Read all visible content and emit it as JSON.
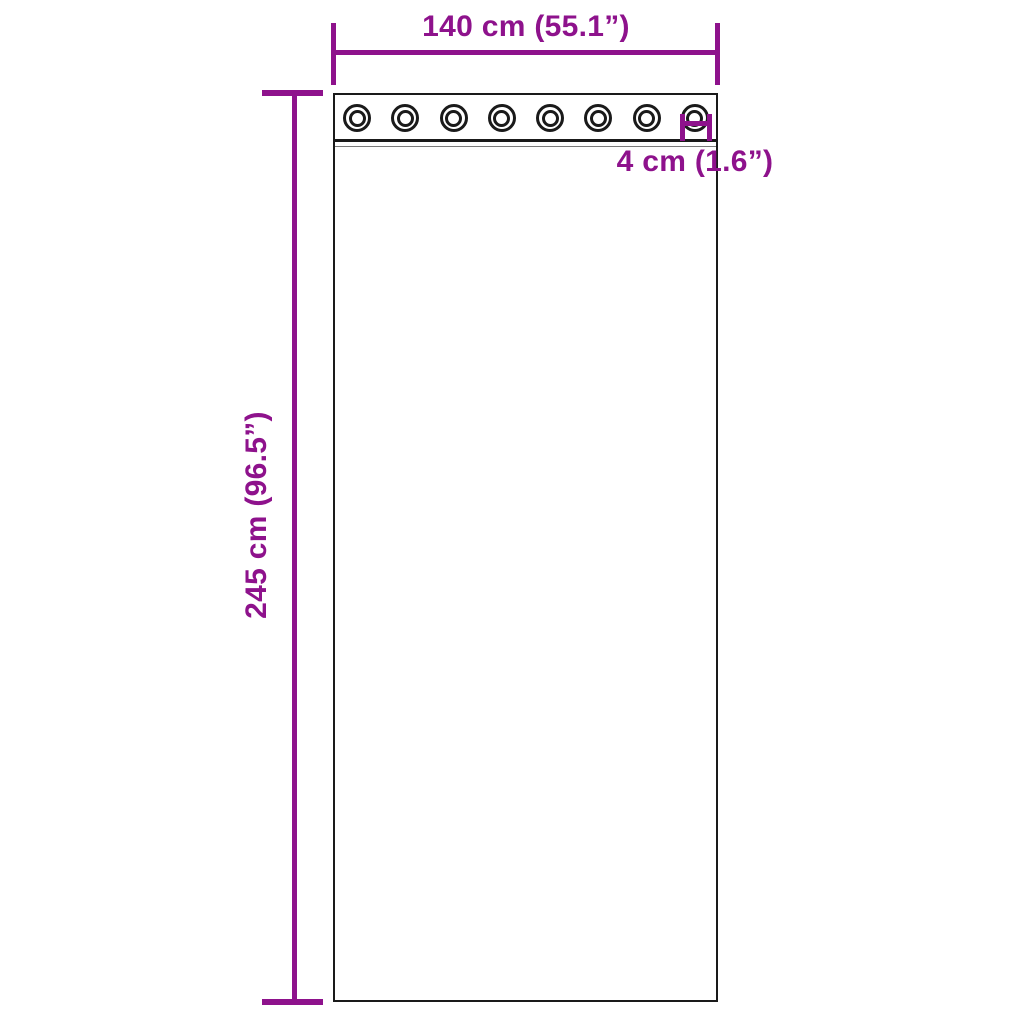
{
  "diagram": {
    "type": "product-dimension-diagram",
    "subject": "curtain panel with grommets",
    "width_label": "140 cm (55.1”)",
    "height_label": "245 cm (96.5”)",
    "grommet_label": "4 cm (1.6”)",
    "grommet_count": 8,
    "dimensions": {
      "width_cm": 140,
      "width_in": 55.1,
      "height_cm": 245,
      "height_in": 96.5,
      "grommet_cm": 4,
      "grommet_in": 1.6
    },
    "colors": {
      "dimension": "#8E128C",
      "outline": "#1a1a1a",
      "background": "#ffffff"
    }
  }
}
